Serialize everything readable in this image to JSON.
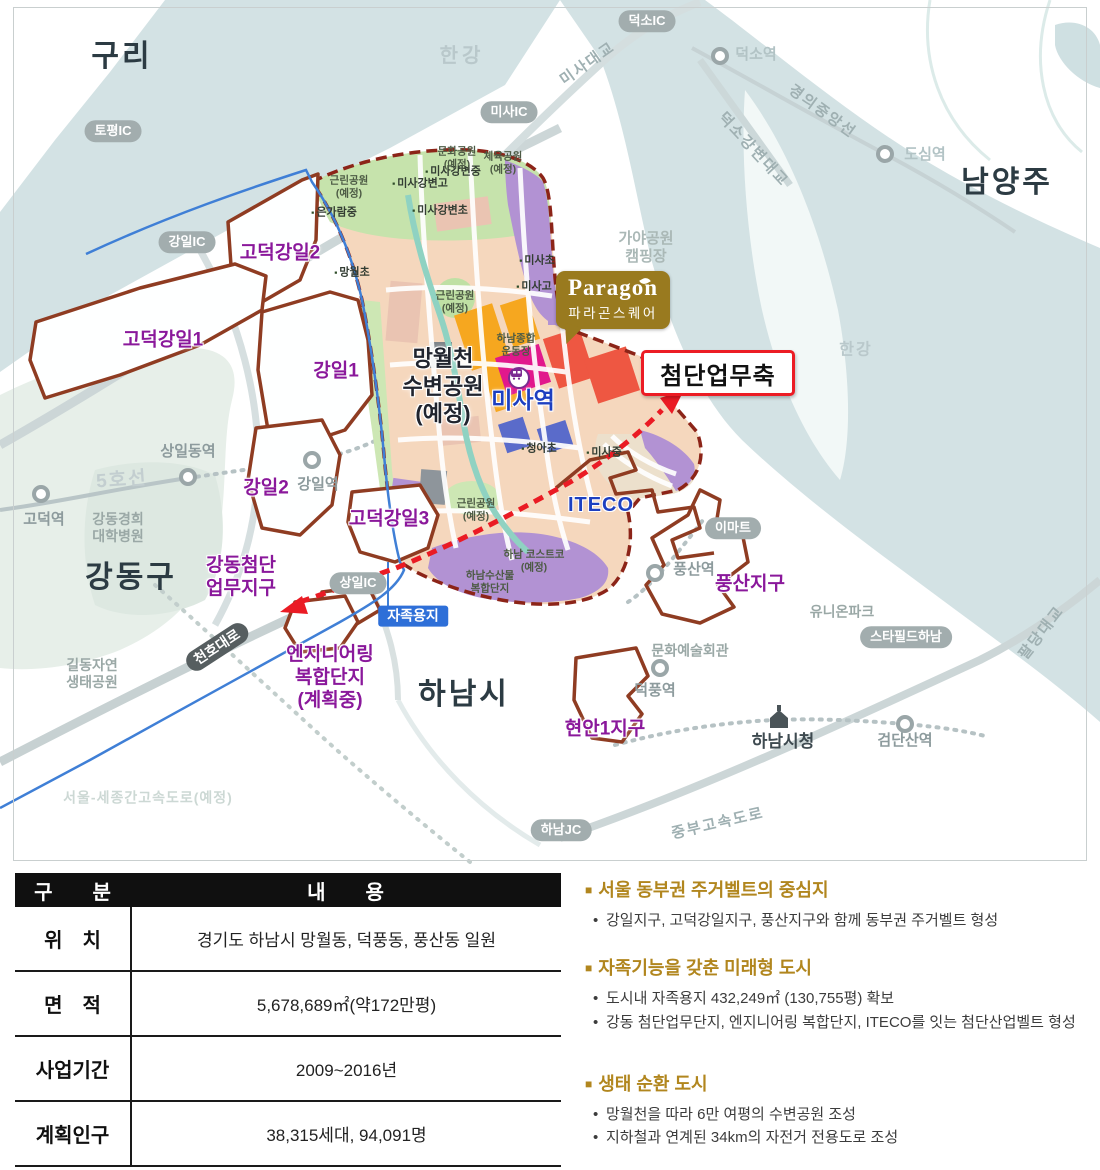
{
  "map": {
    "paragon": {
      "brand": "Paragon",
      "subtitle": "파라곤스퀘어"
    },
    "axis_callout": "첨단업무축",
    "labels": [
      {
        "id": "guri-label",
        "text": "구리",
        "x": 122,
        "y": 57,
        "cls": "city"
      },
      {
        "id": "namyangju-label",
        "text": "남양주",
        "x": 1007,
        "y": 183,
        "cls": "city"
      },
      {
        "id": "gangdong-gu-label",
        "text": "강동구",
        "x": 131,
        "y": 578,
        "cls": "city"
      },
      {
        "id": "hanam-si-label",
        "text": "하남시",
        "x": 464,
        "y": 695,
        "cls": "city"
      },
      {
        "id": "hangang-top-label",
        "text": "한강",
        "x": 462,
        "y": 56,
        "cls": "water-lb"
      },
      {
        "id": "hangang-right-label",
        "text": "한강",
        "x": 856,
        "y": 350,
        "cls": "water-lb water-sm"
      },
      {
        "id": "topyeong-ic-badge",
        "text": "토평IC",
        "x": 113,
        "y": 131,
        "cls": "pill"
      },
      {
        "id": "gangil-ic-badge",
        "text": "강일IC",
        "x": 187,
        "y": 242,
        "cls": "pill"
      },
      {
        "id": "misa-ic-badge",
        "text": "미사IC",
        "x": 509,
        "y": 112,
        "cls": "pill"
      },
      {
        "id": "deokso-ic-badge",
        "text": "덕소IC",
        "x": 647,
        "y": 21,
        "cls": "pill"
      },
      {
        "id": "sangil-ic-badge",
        "text": "상일IC",
        "x": 358,
        "y": 583,
        "cls": "pill"
      },
      {
        "id": "hanam-jc-badge",
        "text": "하남JC",
        "x": 561,
        "y": 830,
        "cls": "pill"
      },
      {
        "id": "emart-badge",
        "text": "이마트",
        "x": 733,
        "y": 528,
        "cls": "pill"
      },
      {
        "id": "starfield-badge",
        "text": "스타필드하남",
        "x": 906,
        "y": 637,
        "cls": "pill"
      },
      {
        "id": "jajok-yongji-badge",
        "text": "자족용지",
        "x": 413,
        "y": 616,
        "cls": "badge-blue"
      },
      {
        "id": "cheonho-daero-badge",
        "text": "천호대로",
        "x": 217,
        "y": 647,
        "cls": "badge-dark",
        "rot": -33
      },
      {
        "id": "godeok-gangil2-label",
        "text": "고덕강일2",
        "x": 280,
        "y": 254,
        "cls": "district"
      },
      {
        "id": "godeok-gangil1-label",
        "text": "고덕강일1",
        "x": 163,
        "y": 341,
        "cls": "district"
      },
      {
        "id": "gangil1-label",
        "text": "강일1",
        "x": 336,
        "y": 372,
        "cls": "district"
      },
      {
        "id": "gangil2-label",
        "text": "강일2",
        "x": 266,
        "y": 489,
        "cls": "district"
      },
      {
        "id": "godeok-gangil3-label",
        "text": "고덕강일3",
        "x": 389,
        "y": 520,
        "cls": "district"
      },
      {
        "id": "pungsan-jigu-label",
        "text": "풍산지구",
        "x": 750,
        "y": 585,
        "cls": "district"
      },
      {
        "id": "hyeonan1-jigu-label",
        "text": "현안1지구",
        "x": 605,
        "y": 730,
        "cls": "district"
      },
      {
        "id": "gangdong-biz-label",
        "text": "강동첨단\n업무지구",
        "x": 241,
        "y": 578,
        "cls": "district"
      },
      {
        "id": "eng-complex-label",
        "text": "엔지니어링\n복합단지\n(계획중)",
        "x": 330,
        "y": 678,
        "cls": "district"
      },
      {
        "id": "misa-station-label",
        "text": "미사역",
        "x": 523,
        "y": 401,
        "cls": "blue-big"
      },
      {
        "id": "iteco-label",
        "text": "ITECO",
        "x": 601,
        "y": 505,
        "cls": "blue-mid"
      },
      {
        "id": "mangwolcheon-park-label",
        "text": "망월천\n수변공원\n(예정)",
        "x": 443,
        "y": 386,
        "cls": "dark-big"
      },
      {
        "id": "sangildong-station-label",
        "text": "상일동역",
        "x": 188,
        "y": 452,
        "cls": "stn"
      },
      {
        "id": "godeok-station-label",
        "text": "고덕역",
        "x": 44,
        "y": 520,
        "cls": "stn"
      },
      {
        "id": "gangil-station-label",
        "text": "강일역",
        "x": 318,
        "y": 485,
        "cls": "stn"
      },
      {
        "id": "pungsan-station-label",
        "text": "풍산역",
        "x": 694,
        "y": 570,
        "cls": "stn"
      },
      {
        "id": "deokpung-station-label",
        "text": "덕풍역",
        "x": 655,
        "y": 691,
        "cls": "stn"
      },
      {
        "id": "geomdansan-station-label",
        "text": "검단산역",
        "x": 905,
        "y": 741,
        "cls": "stn"
      },
      {
        "id": "dosim-station-label",
        "text": "도심역",
        "x": 925,
        "y": 155,
        "cls": "stn-lt"
      },
      {
        "id": "deokso-station-label",
        "text": "덕소역",
        "x": 756,
        "y": 55,
        "cls": "stn-lt"
      },
      {
        "id": "gildong-eco-park-label",
        "text": "길동자연\n생태공원",
        "x": 92,
        "y": 674,
        "cls": "gray"
      },
      {
        "id": "kyunghee-hospital-label",
        "text": "강동경희\n대학병원",
        "x": 118,
        "y": 528,
        "cls": "gray"
      },
      {
        "id": "munhwa-art-hall-label",
        "text": "문화예술회관",
        "x": 690,
        "y": 651,
        "cls": "gray"
      },
      {
        "id": "union-park-label",
        "text": "유니온파크",
        "x": 842,
        "y": 612,
        "cls": "gray"
      },
      {
        "id": "gaya-park-label",
        "text": "가야공원\n캠핑장",
        "x": 646,
        "y": 248,
        "cls": "gray-lt"
      },
      {
        "id": "hanam-cityhall-label",
        "text": "하남시청",
        "x": 783,
        "y": 742,
        "cls": "city-sm"
      },
      {
        "id": "misa-bridge-label",
        "text": "미사대교",
        "x": 588,
        "y": 64,
        "cls": "road",
        "rot": -35
      },
      {
        "id": "gyeongui-line-label",
        "text": "경의중앙선",
        "x": 822,
        "y": 112,
        "cls": "road",
        "rot": 36
      },
      {
        "id": "deokso-bridge-label",
        "text": "덕소강변대교",
        "x": 753,
        "y": 150,
        "cls": "road",
        "rot": 47
      },
      {
        "id": "paldang-bridge-label",
        "text": "팔당대교",
        "x": 1042,
        "y": 633,
        "cls": "road",
        "rot": -52
      },
      {
        "id": "jungbu-expressway-label",
        "text": "중부고속도로",
        "x": 718,
        "y": 824,
        "cls": "road",
        "rot": -13
      },
      {
        "id": "line5-label",
        "text": "5호선",
        "x": 122,
        "y": 481,
        "cls": "road-big",
        "rot": -4
      },
      {
        "id": "sejong-expressway-label",
        "text": "서울-세종간고속도로(예정)",
        "x": 148,
        "y": 798,
        "cls": "ghost"
      },
      {
        "id": "eungaram-mid-label",
        "text": "은가람중",
        "x": 334,
        "y": 213,
        "cls": "school",
        "icon": true
      },
      {
        "id": "misagangbyeon-mid-label",
        "text": "미사강변중",
        "x": 453,
        "y": 172,
        "cls": "school",
        "icon": true
      },
      {
        "id": "misagangbyeon-high-label",
        "text": "미사강변고",
        "x": 420,
        "y": 184,
        "cls": "school",
        "icon": true
      },
      {
        "id": "misagangbyeon-ele-label",
        "text": "미사강변초",
        "x": 440,
        "y": 211,
        "cls": "school",
        "icon": true
      },
      {
        "id": "mangwol-ele-label",
        "text": "망월초",
        "x": 352,
        "y": 273,
        "cls": "school",
        "icon": true
      },
      {
        "id": "misa-ele-label",
        "text": "미사초",
        "x": 537,
        "y": 261,
        "cls": "school",
        "icon": true
      },
      {
        "id": "misa-high-label",
        "text": "미사고",
        "x": 534,
        "y": 287,
        "cls": "school",
        "icon": true
      },
      {
        "id": "cheonga-ele-label",
        "text": "청아초",
        "x": 539,
        "y": 449,
        "cls": "school",
        "icon": true
      },
      {
        "id": "misa-mid-label",
        "text": "미사중",
        "x": 604,
        "y": 453,
        "cls": "school",
        "icon": true
      },
      {
        "id": "munhwa-park-label",
        "text": "문화공원\n(예정)",
        "x": 457,
        "y": 158,
        "cls": "park"
      },
      {
        "id": "cheyuk-park-label",
        "text": "체육공원\n(예정)",
        "x": 503,
        "y": 163,
        "cls": "park"
      },
      {
        "id": "geunrin-park-nw-label",
        "text": "근린공원\n(예정)",
        "x": 349,
        "y": 187,
        "cls": "park"
      },
      {
        "id": "geunrin-park-c-label",
        "text": "근린공원\n(예정)",
        "x": 455,
        "y": 302,
        "cls": "park"
      },
      {
        "id": "geunrin-park-s-label",
        "text": "근린공원\n(예정)",
        "x": 476,
        "y": 510,
        "cls": "park"
      },
      {
        "id": "sports-complex-label",
        "text": "하남종합\n운동장",
        "x": 516,
        "y": 345,
        "cls": "park"
      },
      {
        "id": "costco-label",
        "text": "하남 코스트코\n(예정)",
        "x": 534,
        "y": 561,
        "cls": "park"
      },
      {
        "id": "susan-complex-label",
        "text": "하남수산물\n복합단지",
        "x": 490,
        "y": 582,
        "cls": "park"
      }
    ]
  },
  "table": {
    "header": {
      "col1": "구　　분",
      "col2": "내　　용"
    },
    "rows": [
      {
        "label": "위　치",
        "value": "경기도 하남시 망월동, 덕풍동, 풍산동 일원"
      },
      {
        "label": "면　적",
        "value": "5,678,689㎡(약172만평)"
      },
      {
        "label": "사업기간",
        "value": "2009~2016년"
      },
      {
        "label": "계획인구",
        "value": "38,315세대, 94,091명"
      }
    ]
  },
  "highlights": {
    "sections": [
      {
        "title": "서울 동부권 주거벨트의 중심지",
        "bullets": [
          "강일지구, 고덕강일지구, 풍산지구와 함께 동부권 주거벨트 형성"
        ]
      },
      {
        "title": "자족기능을 갖춘 미래형 도시",
        "bullets": [
          "도시내 자족용지 432,249㎡ (130,755평) 확보",
          "강동 첨단업무단지, 엔지니어링 복합단지, ITECO를 잇는 첨단산업벨트 형성"
        ]
      },
      {
        "title": "생태 순환 도시",
        "bullets": [
          "망월천을 따라 6만 여평의 수변공원 조성",
          "지하철과 연계된 34km의 자전거 전용도로 조성"
        ]
      }
    ]
  },
  "colors": {
    "district_boundary": "#8c2418",
    "outline_brown": "#8f3c22",
    "arrow_red": "#ea1b24",
    "accent_gold": "#b1861e",
    "paragon_bg": "#997a1f",
    "water": "#d3e2e4",
    "residential_peach": "#f5d7bd",
    "park_green": "#c6e3ac",
    "commercial_purple": "#b292d3",
    "label_purple": "#8a189b",
    "label_blue": "#1d3fc0"
  }
}
